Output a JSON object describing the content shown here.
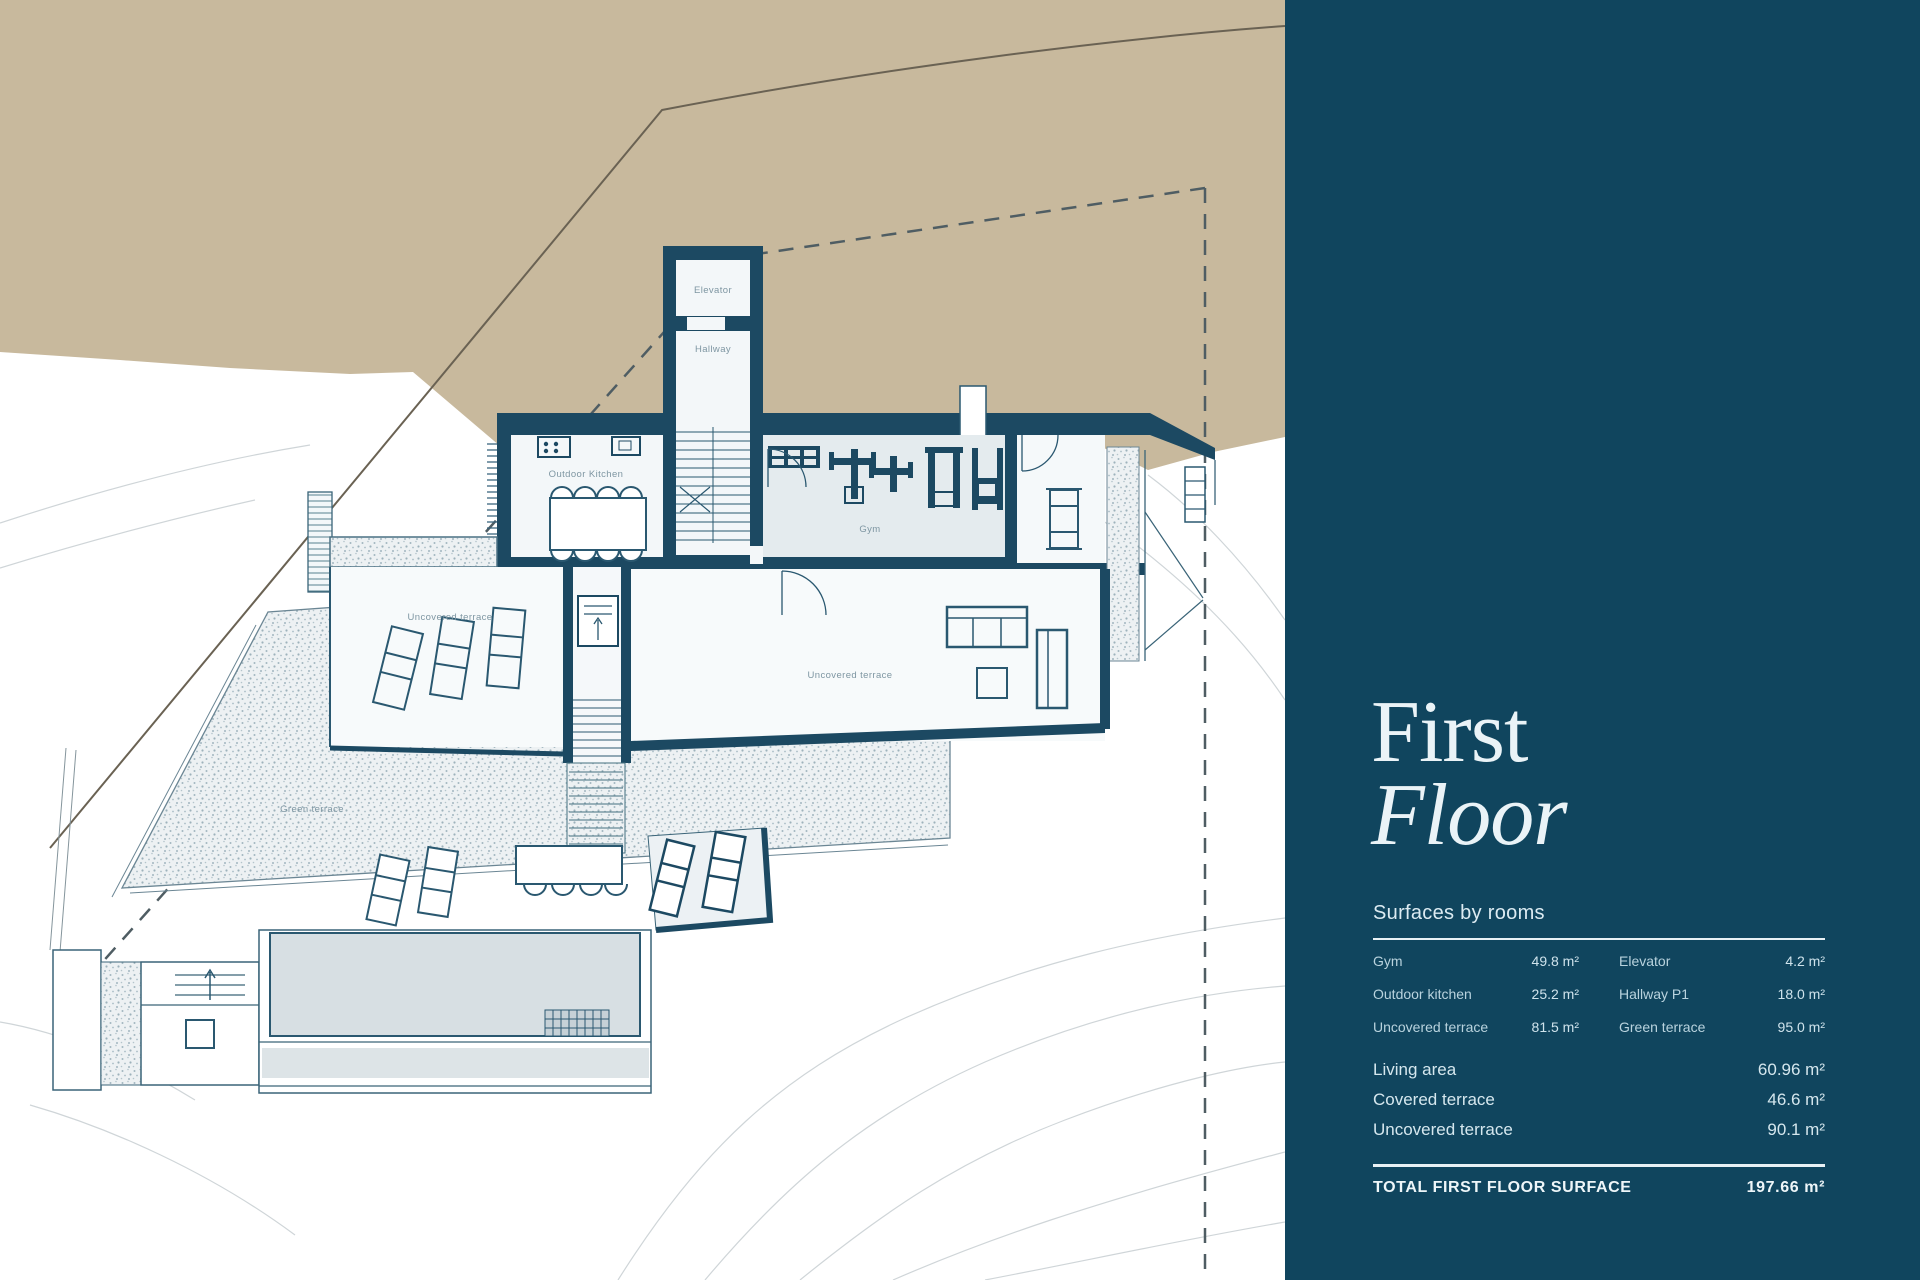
{
  "sidebar": {
    "title_line1": "First",
    "title_line2": "Floor",
    "section_header": "Surfaces by rooms",
    "rooms": [
      {
        "label": "Gym",
        "value": "49.8 m²"
      },
      {
        "label": "Outdoor kitchen",
        "value": "25.2 m²"
      },
      {
        "label": "Uncovered terrace",
        "value": "81.5 m²"
      },
      {
        "label": "Elevator",
        "value": "4.2 m²"
      },
      {
        "label": "Hallway P1",
        "value": "18.0 m²"
      },
      {
        "label": "Green terrace",
        "value": "95.0 m²"
      }
    ],
    "summary": [
      {
        "label": "Living area",
        "value": "60.96 m²"
      },
      {
        "label": "Covered terrace",
        "value": "46.6 m²"
      },
      {
        "label": "Uncovered terrace",
        "value": "90.1 m²"
      }
    ],
    "total": {
      "label": "TOTAL FIRST FLOOR SURFACE",
      "value": "197.66 m²"
    }
  },
  "plan": {
    "labels": {
      "elevator": "Elevator",
      "hallway": "Hallway",
      "outdoor_kitchen": "Outdoor Kitchen",
      "gym": "Gym",
      "uncovered_terrace_left": "Uncovered terrace",
      "uncovered_terrace_right": "Uncovered terrace",
      "green_terrace": "Green terrace"
    }
  },
  "colors": {
    "sidebar_bg": "#10455e",
    "wall_navy": "#1c4962",
    "terrain_tan": "#c8b99d",
    "room_fill": "#f3f7f9",
    "gym_fill": "#e4ebee",
    "pool_fill": "#d7dfe3",
    "stipple_gray": "#a2b6bf",
    "sidebar_text": "#d5e7ee"
  }
}
